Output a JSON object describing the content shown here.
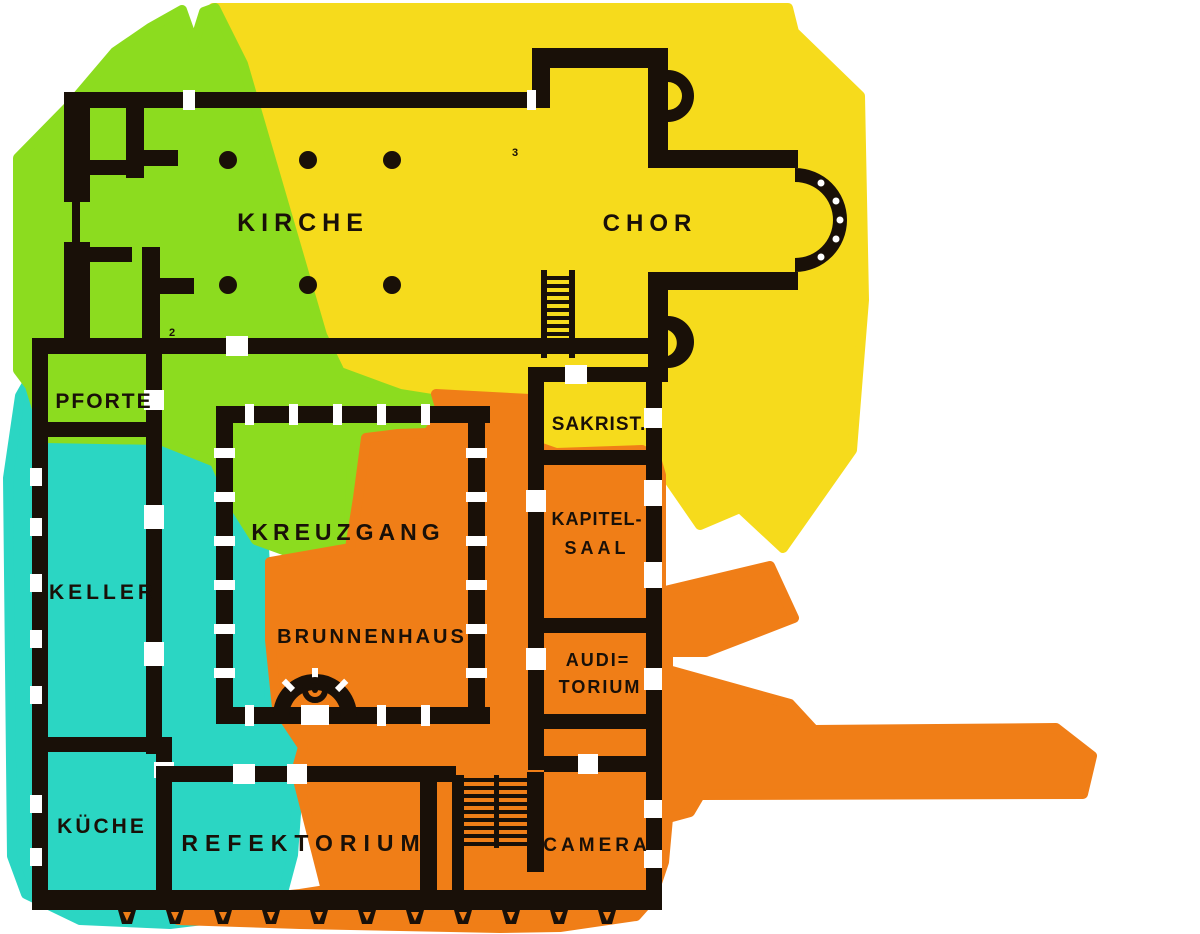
{
  "diagram": {
    "rooms": {
      "kirche": "KIRCHE",
      "chor": "CHOR",
      "pforte": "PFORTE",
      "sakristei": "SAKRIST.",
      "keller": "KELLER",
      "kreuzgang": "KREUZGANG",
      "brunnenhaus": "BRUNNENHAUS",
      "kapitelsaal_line1": "KAPITEL-",
      "kapitelsaal_line2": "SAAL",
      "auditorium_line1": "AUDI=",
      "auditorium_line2": "TORIUM",
      "kueche": "KÜCHE",
      "refektorium": "REFEKTORIUM",
      "camera": "CAMERA"
    },
    "annotations": {
      "numeral_2": "2",
      "numeral_3": "3"
    },
    "colors": {
      "zone_yellow": "#F6DB1C",
      "zone_green": "#8CDC1F",
      "zone_cyan": "#2BD6C3",
      "zone_orange": "#F07E17",
      "ink": "#191008",
      "background": "#FFFFFF"
    }
  }
}
